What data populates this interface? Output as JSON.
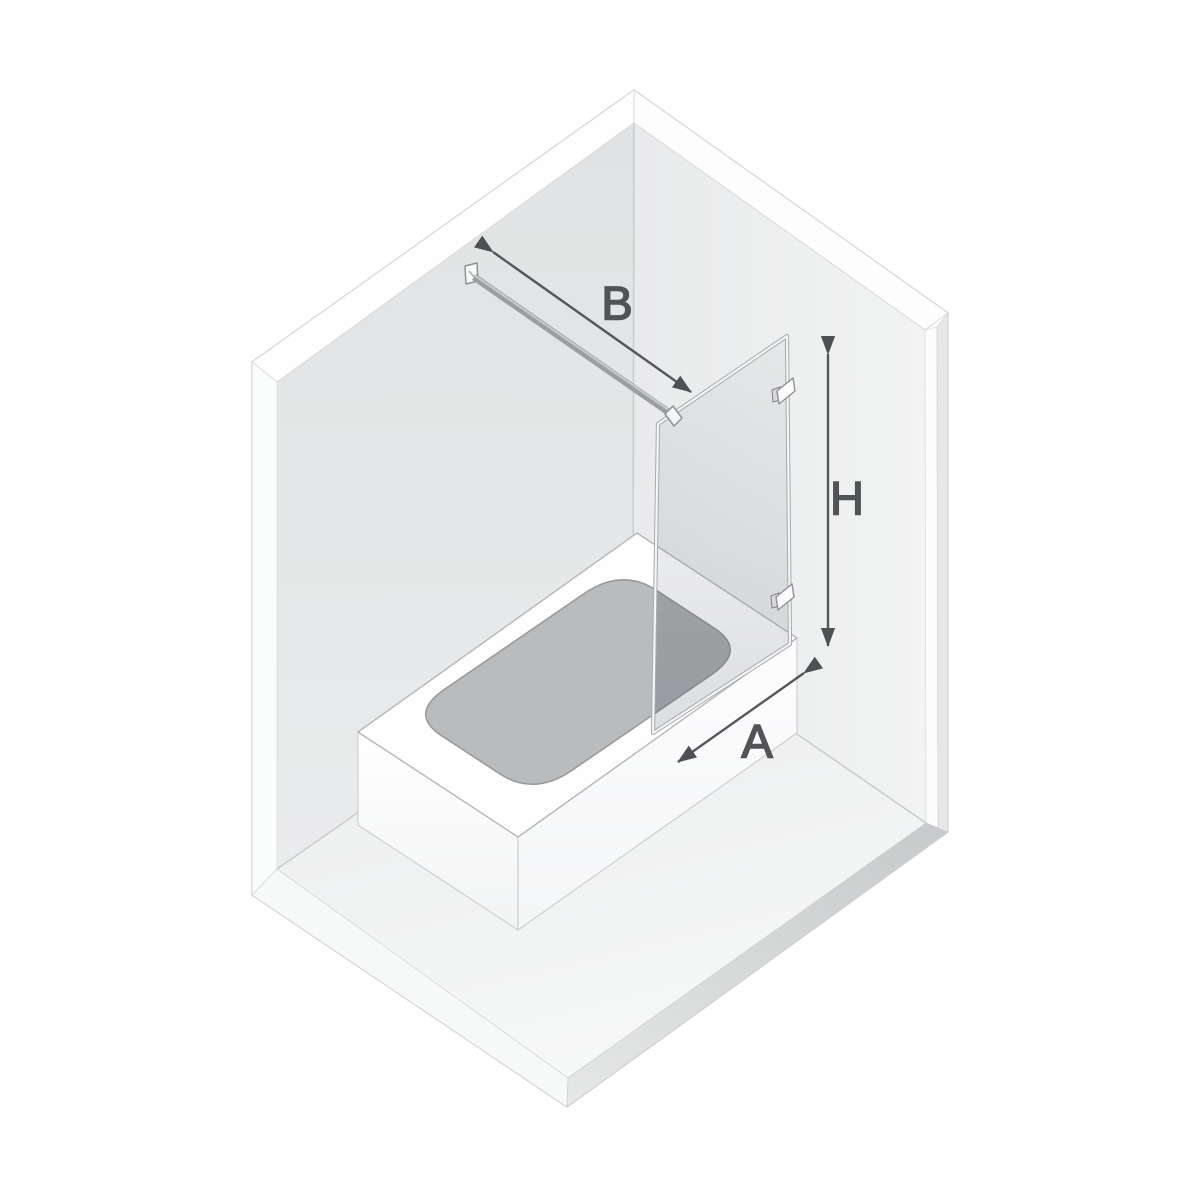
{
  "diagram": {
    "title": "isometric-bath-screen-dimension-diagram",
    "labels": {
      "bar_length": "B",
      "screen_height": "H",
      "screen_width": "A"
    },
    "colors": {
      "dimension_line": "#55575a",
      "dimension_text": "#515356",
      "wall_left": "#e4e5e6",
      "wall_right": "#eeefef",
      "floor": "#eceded",
      "floor_edge": "#cbcdce",
      "tub_body": "#ffffff",
      "basin": "#babbbd",
      "glass_tint": "#565c66",
      "hardware": "#9b9da0"
    }
  }
}
